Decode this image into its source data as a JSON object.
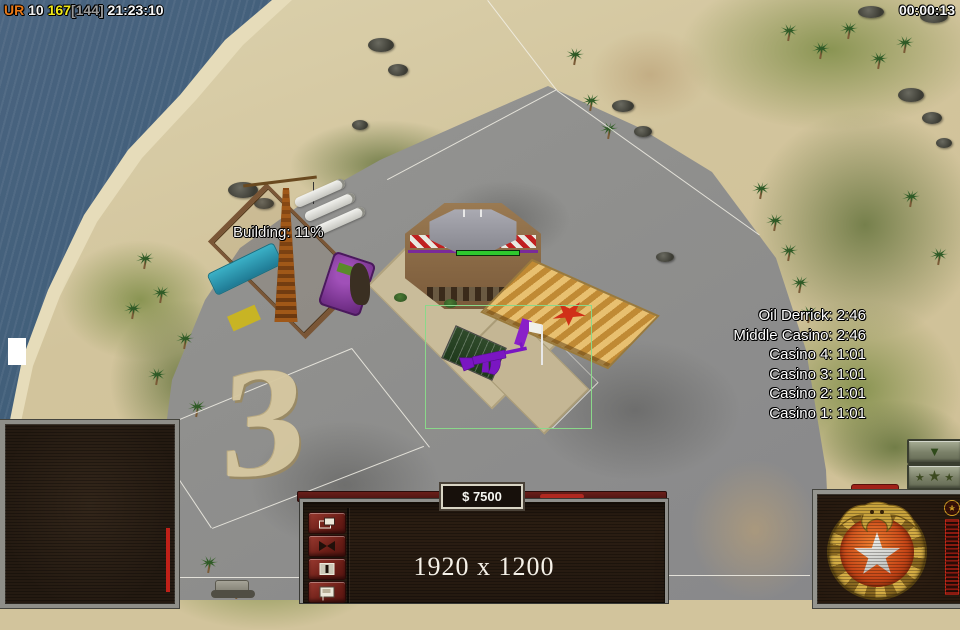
{
  "hud": {
    "player_tag": "UR",
    "player_number": " 10 ",
    "score": "167",
    "score_bracket": "[144]",
    "clock": " 21:23:10",
    "match_timer": "00:00:13",
    "building_progress": "Building: 11%",
    "ground_numeral": "3",
    "timers": [
      "Oil Derrick: 2:46",
      "Middle Casino: 2:46",
      "Casino 4: 1:01",
      "Casino 3: 1:01",
      "Casino 2: 1:01",
      "Casino 1: 1:01"
    ]
  },
  "console": {
    "money": "$ 7500",
    "resolution": "1920 x 1200",
    "button_icons": [
      "stacked-windows-icon",
      "bowtie-icon",
      "pause-box-icon",
      "poster-icon"
    ]
  },
  "rank": {
    "down_glyph": "▼",
    "star_glyph": "★"
  },
  "panel": {
    "xp_star_glyph": "★"
  },
  "colors": {
    "water": "#3b5b76",
    "sand": "#d2c49c",
    "grass": "#7f8c4c",
    "concrete": "#8f8f8d",
    "selection_green": "#8ad88a",
    "console_red": "#6a1f1a",
    "button_red": "#8a2a24",
    "gold": "#c8a23c",
    "china_orange": "#c84818"
  }
}
